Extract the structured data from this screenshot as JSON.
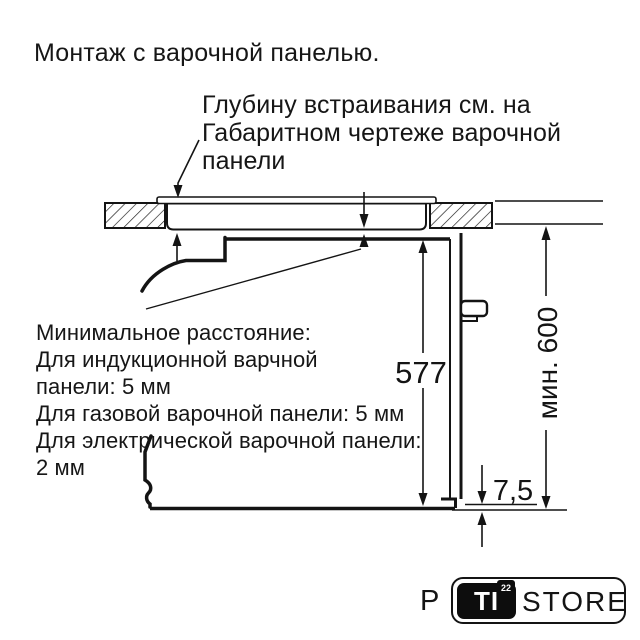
{
  "title": "Монтаж с варочной панелью.",
  "notes": {
    "embed_depth": "Глубину встраивания см. на\nГабаритном чертеже варочной\nпанели",
    "min_distance": "Минимальное расстояние:\nДля индукционной варчной\nпанели: 5 мм\nДля газовой варочной панели: 5 мм\nДля электрической варочной панели:\n2 мм"
  },
  "dimensions": {
    "oven_height": "577",
    "niche_height_min": "мин. 600",
    "bottom_clearance": "7,5"
  },
  "watermark": {
    "prefix": "P",
    "badge_text": "TI",
    "badge_superscript": "22",
    "suffix": "STORE"
  },
  "colors": {
    "line": "#141414",
    "background": "#ffffff",
    "badge_bg": "#0d0d0d",
    "badge_text": "#ffffff"
  }
}
